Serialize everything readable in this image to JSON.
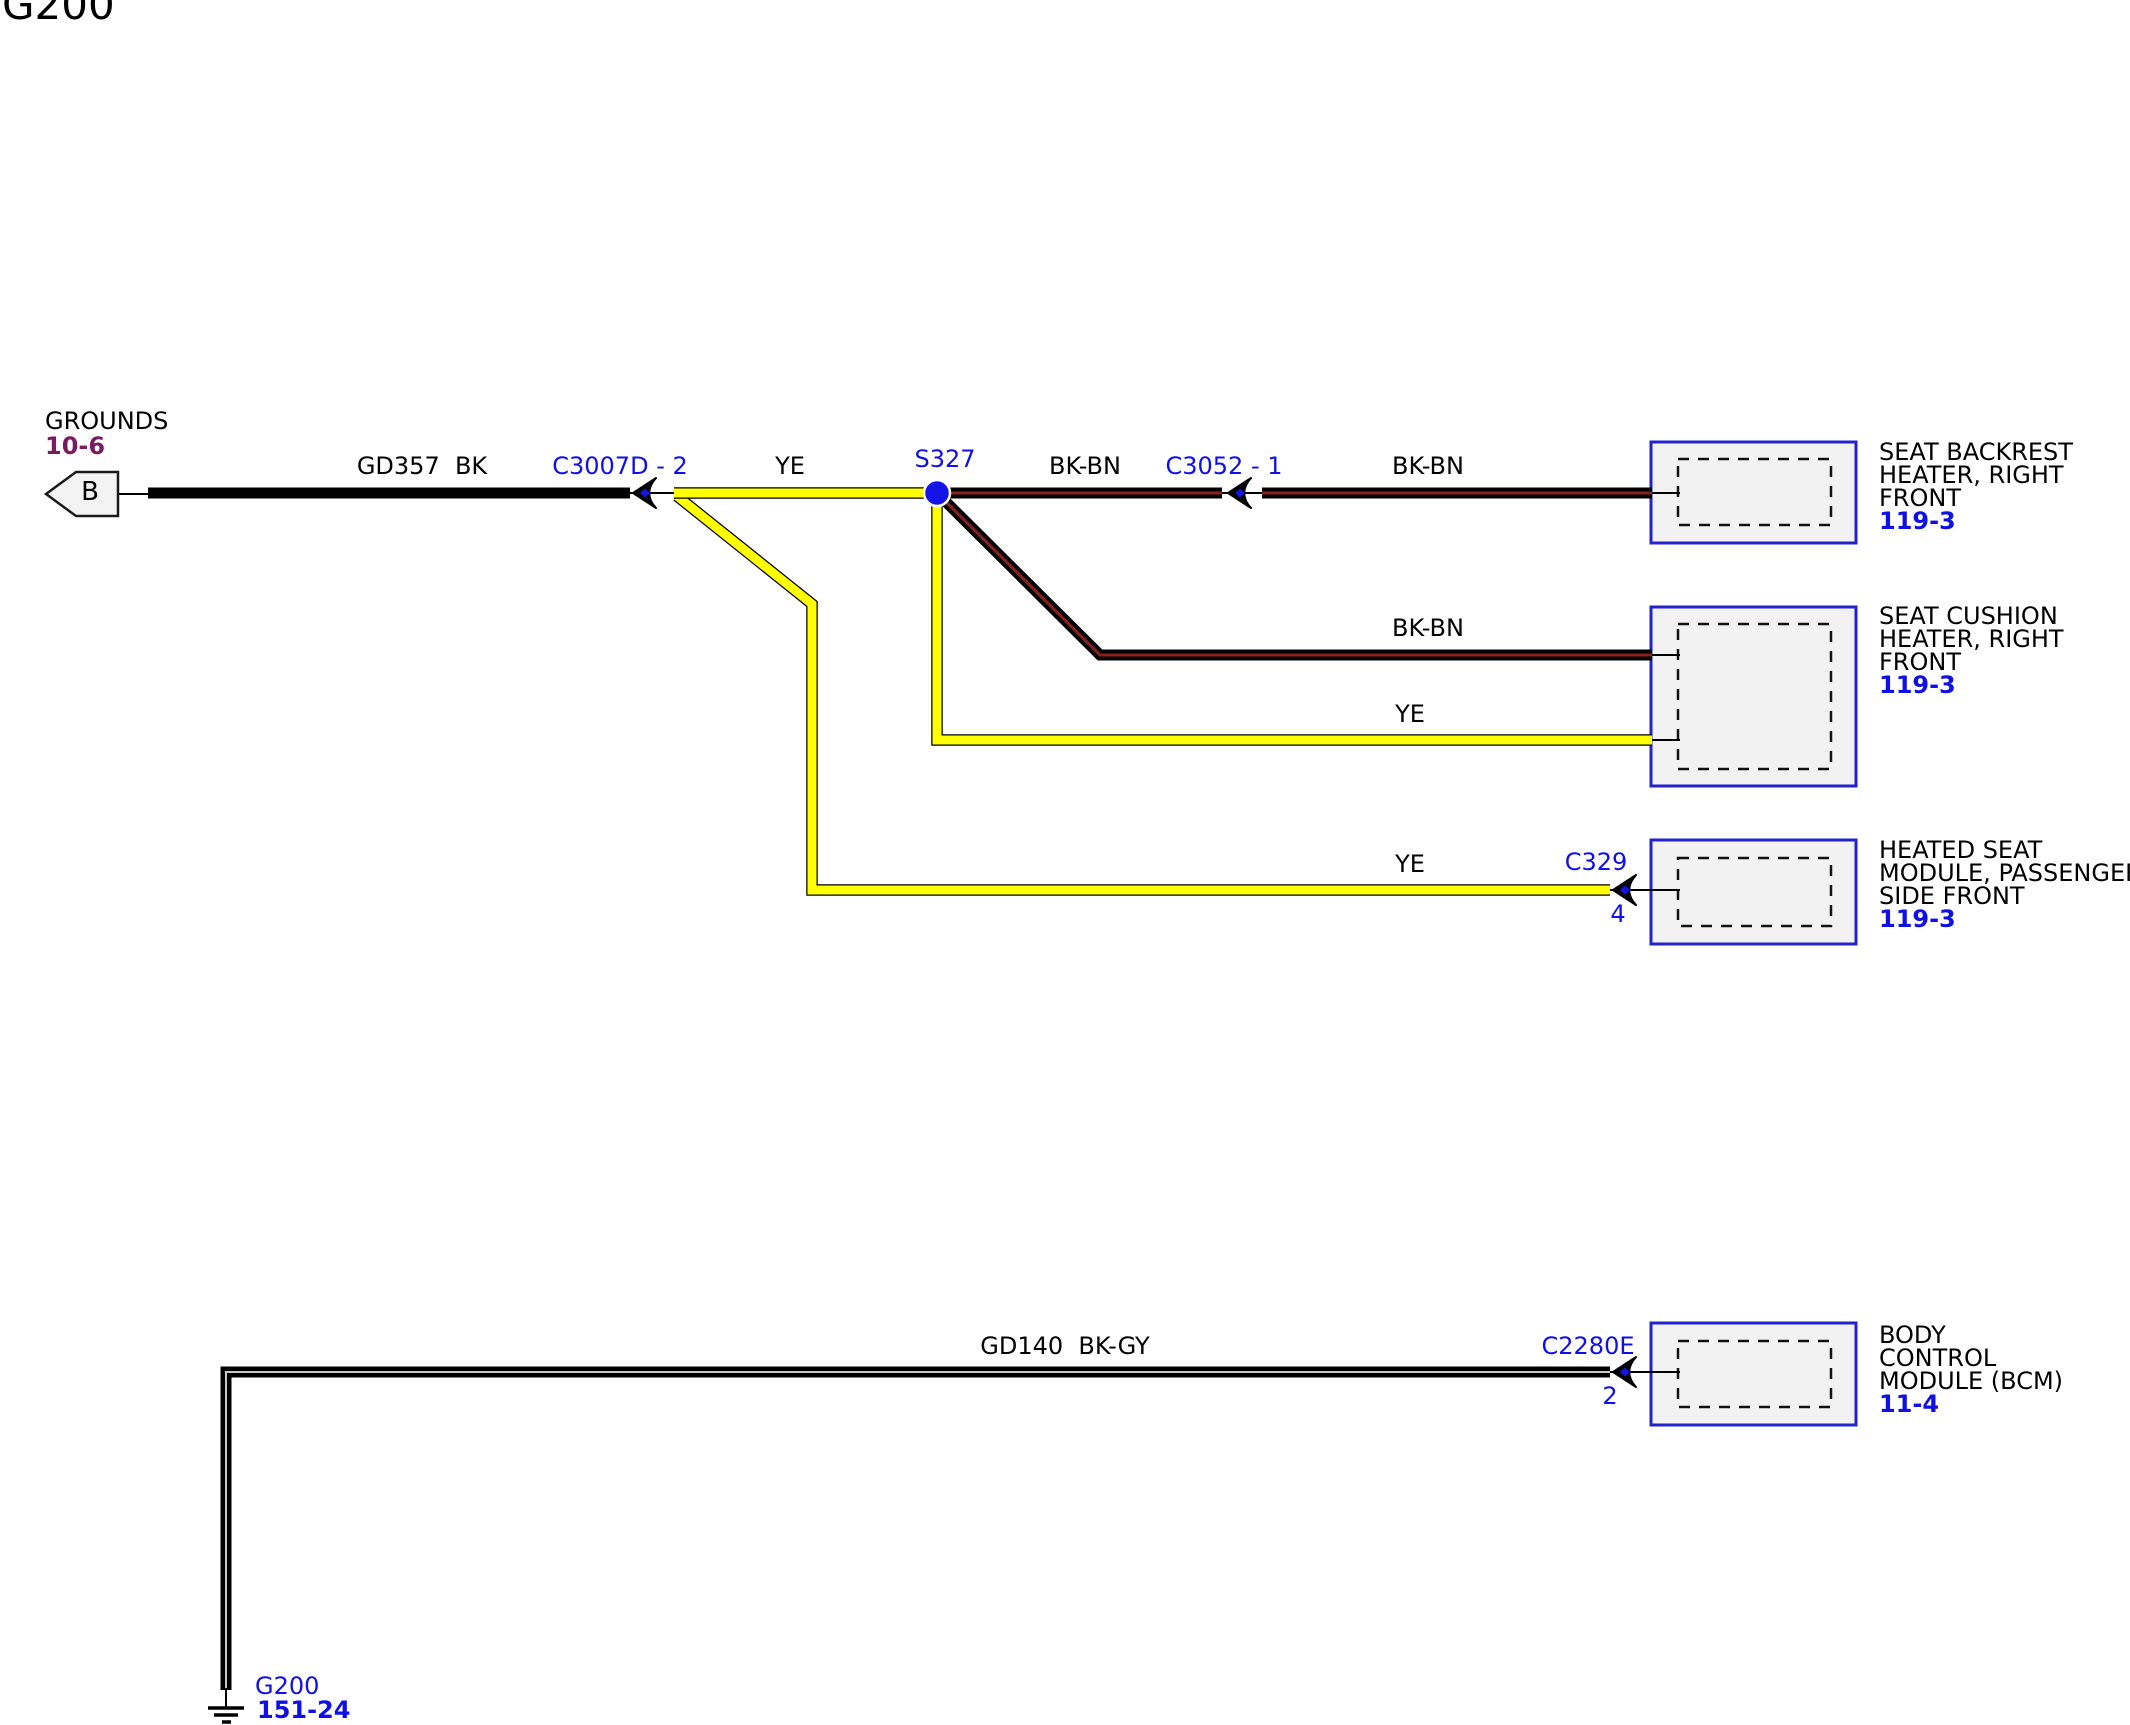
{
  "title": "G200",
  "ground_feed": {
    "label": "GROUNDS",
    "page": "10-6",
    "flag": "B"
  },
  "wire_labels": {
    "gd357": "GD357  BK",
    "ye_main": "YE",
    "bkbn_1": "BK-BN",
    "bkbn_2": "BK-BN",
    "bkbn_3": "BK-BN",
    "ye_cushion": "YE",
    "ye_module": "YE",
    "gd140": "GD140  BK-GY"
  },
  "splice": {
    "label": "S327"
  },
  "connectors": {
    "c3007d": {
      "label": "C3007D - 2"
    },
    "c3052": {
      "label": "C3052 - 1"
    },
    "c329": {
      "label": "C329",
      "pin": "4"
    },
    "c2280e": {
      "label": "C2280E",
      "pin": "2"
    }
  },
  "components": {
    "seat_backrest": {
      "lines": [
        "SEAT BACKREST",
        "HEATER, RIGHT",
        "FRONT"
      ],
      "page": "119-3"
    },
    "seat_cushion": {
      "lines": [
        "SEAT CUSHION",
        "HEATER, RIGHT",
        "FRONT"
      ],
      "page": "119-3"
    },
    "heated_seat_module": {
      "lines": [
        "HEATED SEAT",
        "MODULE, PASSENGER",
        "SIDE FRONT"
      ],
      "page": "119-3"
    },
    "bcm": {
      "lines": [
        "BODY",
        "CONTROL",
        "MODULE (BCM)"
      ],
      "page": "11-4"
    }
  },
  "ground_point": {
    "label": "G200",
    "page": "151-24"
  },
  "colors": {
    "link_blue": "#0f0fe8",
    "page_ref_purple": "#7a1b62",
    "wire_yellow": "#ffff00",
    "wire_black": "#000000",
    "bkbn_stripe": "#8b2020",
    "bkgy_stripe": "#c8c8c8",
    "box_fill": "#f2f2f2",
    "box_border": "#2323cc",
    "splice_blue": "#1414e6"
  }
}
